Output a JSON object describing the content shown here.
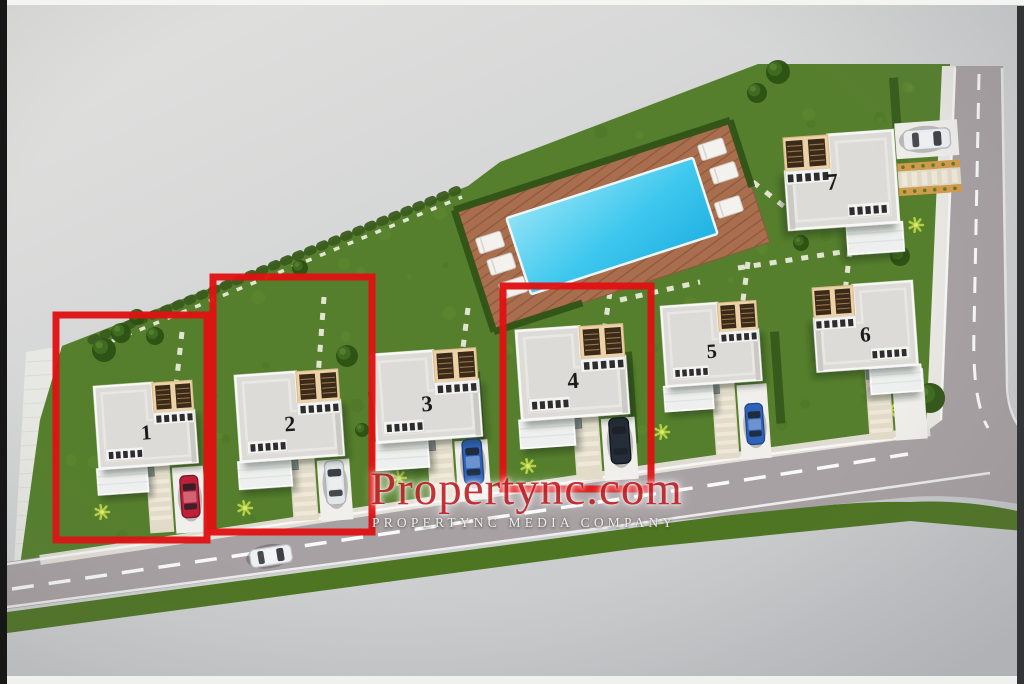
{
  "watermark": {
    "title": "Propertync.com",
    "subtitle": "PROPERTYNC MEDIA COMPANY"
  },
  "site": {
    "villas": [
      {
        "number": "1",
        "highlighted": true,
        "car": "red"
      },
      {
        "number": "2",
        "highlighted": true,
        "car": "silver"
      },
      {
        "number": "3",
        "highlighted": false,
        "car": "blue"
      },
      {
        "number": "4",
        "highlighted": true,
        "car": "dark"
      },
      {
        "number": "5",
        "highlighted": false,
        "car": "blue"
      },
      {
        "number": "6",
        "highlighted": false,
        "car": null
      },
      {
        "number": "7",
        "highlighted": false,
        "car": "white"
      }
    ],
    "road_vehicles": [
      {
        "car": "white"
      }
    ],
    "amenities": [
      "swimming-pool",
      "sun-deck"
    ]
  },
  "colors": {
    "highlight": "#e01212",
    "pool_water": "#36c3ec",
    "deck": "#a86e4e",
    "grass": "#557f2c",
    "road": "#a8a1a3",
    "roof": "#dcdbd7",
    "terrace": "#ecd2a6",
    "background": "#d2d3d4",
    "car_colors": {
      "red": "#bf2039",
      "silver": "#e3e6e8",
      "blue": "#2f63b8",
      "dark": "#242d39",
      "white": "#eef0f2"
    }
  }
}
